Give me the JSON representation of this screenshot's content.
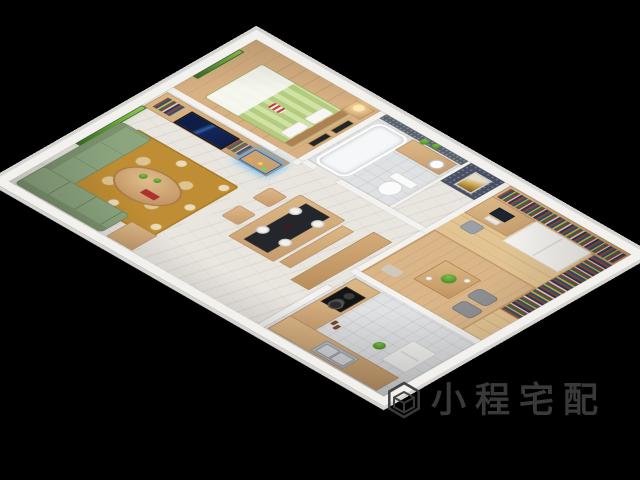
{
  "scene": {
    "description": "3D isometric cutaway render of a small furnished apartment on a black background",
    "palette": {
      "background": "#000000",
      "outer_wall": "#f2f1ee",
      "wall_edge": "#d6d4d0",
      "wood_cabinet": "#cda87c",
      "wood_floor": "#ddb98b",
      "marble_floor": "#e9e6e0",
      "sofa_green": "#8ca57f",
      "rug_gold": "#bf8d33",
      "bed_green_stripe": "#b5cc80",
      "tv_screen_navy": "#13265c",
      "aquarium_blue": "#1e8fe0",
      "window_foliage": "#4f9a27",
      "mosaic_wall": "#59616c",
      "table_runner": "#23262b",
      "cooktop_black": "#141414"
    },
    "rooms": [
      {
        "name": "bedroom",
        "furniture": [
          "double-bed",
          "headboard",
          "pillows",
          "white-blanket",
          "striped-accent-pillow",
          "nightstand",
          "table-lamp",
          "framed-art-pair",
          "window-with-trees"
        ]
      },
      {
        "name": "bathroom",
        "furniture": [
          "bathtub",
          "vanity-counter",
          "round-sink",
          "toilet",
          "mosaic-wall",
          "potted-plants"
        ]
      },
      {
        "name": "laundry-nook",
        "furniture": [
          "patterned-wallpaper-panel",
          "framed-art"
        ]
      },
      {
        "name": "study",
        "furniture": [
          "bookshelf-wall",
          "side-bookshelf",
          "white-wardrobe",
          "computer-desk",
          "monitor",
          "keyboard",
          "desk-chair",
          "tatami-platform",
          "low-tea-table",
          "potted-plant",
          "teacups",
          "floor-cushions",
          "pillow"
        ]
      },
      {
        "name": "living-room",
        "furniture": [
          "tv-wall-unit",
          "television",
          "shelf-books",
          "aquarium-with-led",
          "sectional-sofa",
          "oval-coffee-table",
          "red-tray",
          "table-plants",
          "gold-area-rug",
          "window-with-trees",
          "side-cabinet"
        ]
      },
      {
        "name": "dining-room",
        "furniture": [
          "dining-table",
          "black-table-runner",
          "white-plates",
          "wine-bottle",
          "wooden-chairs",
          "bench",
          "partition-console"
        ]
      },
      {
        "name": "kitchen",
        "furniture": [
          "l-shaped-counter",
          "gas-cooktop",
          "cooking-pot",
          "double-sink",
          "white-appliance",
          "condiments",
          "potted-plant"
        ]
      }
    ]
  },
  "watermark": {
    "logo": "hexagon-cube-logo",
    "text": "小程宅配",
    "color": "#3d3d3d"
  }
}
